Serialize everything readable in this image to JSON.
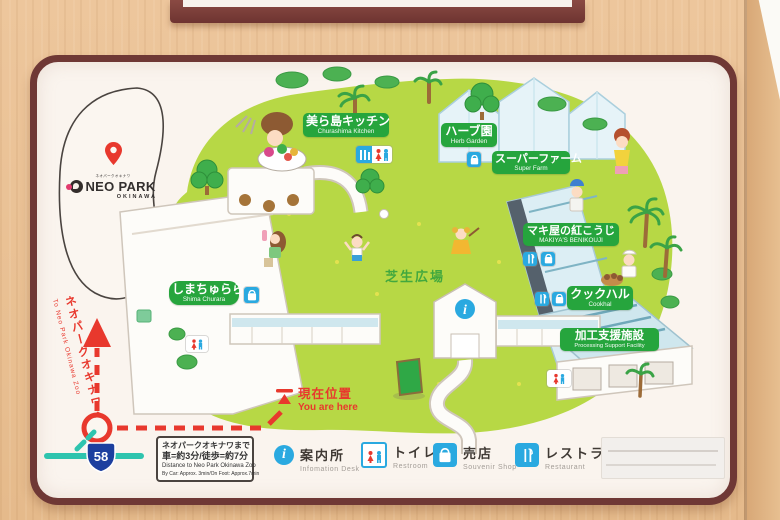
{
  "palette": {
    "wood": "#e9c093",
    "frame_maroon": "#6f3835",
    "board_bg": "#faf4ee",
    "lawn_green": "#b7d845",
    "badge_green": "#26a53d",
    "accent_red": "#e8382d",
    "road_teal": "#2ec4ae",
    "icon_blue": "#2aa9e0",
    "route_shield_blue": "#1c3f9f"
  },
  "logo": {
    "top_text": "ネオパークオキナワ",
    "title": "NEO PARK",
    "subtitle": "OKINAWA"
  },
  "facilities": [
    {
      "jp": "美ら島キッチン",
      "en": "Churashima Kitchen"
    },
    {
      "jp": "ハーブ園",
      "en": "Herb Garden"
    },
    {
      "jp": "スーパーファーム",
      "en": "Super Farm"
    },
    {
      "jp": "マキ屋の紅こうじ",
      "en": "MAKIYA'S BENIKOUJI"
    },
    {
      "jp": "クックハル",
      "en": "Cookhal"
    },
    {
      "jp": "加工支援施設",
      "en": "Processing Support Facility"
    },
    {
      "jp": "しまちゅらら",
      "en": "Shima Churara"
    }
  ],
  "lawn_label": "芝生広場",
  "current_location": {
    "jp": "現在位置",
    "en": "You are here"
  },
  "to_zoo": {
    "jp": "ネオパークオキナワへ",
    "en": "To Neo Park Okinawa Zoo"
  },
  "route_number": "58",
  "distance_box": {
    "line1": "ネオパークオキナワまで",
    "line2": "車=約3分/徒歩=約7分",
    "line3": "Distance to Neo Park Okinawa Zoo",
    "line4": "By Car: Approx. 3min/On Foot: Approx.7min"
  },
  "legend": [
    {
      "jp": "案内所",
      "en": "Infomation Desk",
      "icon": "info-icon"
    },
    {
      "jp": "トイレ",
      "en": "Restroom",
      "icon": "restroom-icon"
    },
    {
      "jp": "売店",
      "en": "Souvenir Shop",
      "icon": "shop-bag-icon"
    },
    {
      "jp": "レストラン",
      "en": "Restaurant",
      "icon": "restaurant-icon"
    }
  ]
}
